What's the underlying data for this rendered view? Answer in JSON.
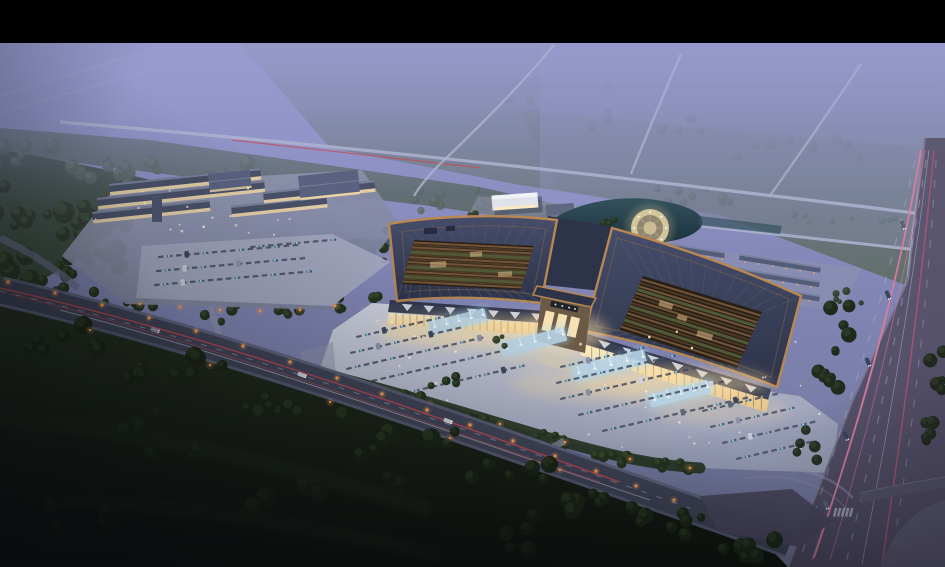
{
  "scene": {
    "type": "architectural-aerial-render",
    "time_of_day": "dusk",
    "description": "Dusk aerial rendering of a large illuminated market complex: two courtyard halls with copper-edged roofs joined by a lit central gate, a bright parking plaza with fountain strips, a secondary market complex with parking at left, a pond with a circular fountain plaza, rows of shop buildings, misty farmland with country roads behind, a tail-light streaked front road and a wide highway with pink light trails at right, dark fields and trees in the foreground, black letterbox bar at top."
  },
  "landmarks": [
    {
      "name": "main-hall-west",
      "label": "West market hall with courtyard roof"
    },
    {
      "name": "main-hall-east",
      "label": "East market hall with courtyard roof"
    },
    {
      "name": "central-gate",
      "label": "Illuminated central gate pavilion"
    },
    {
      "name": "front-plaza",
      "label": "Lit plaza with parking rows and fountain strips"
    },
    {
      "name": "secondary-complex",
      "label": "Secondary market complex with parking lot"
    },
    {
      "name": "circular-plaza",
      "label": "Circular fountain plaza beside pond"
    },
    {
      "name": "pond",
      "label": "Landscape pond and canal"
    },
    {
      "name": "shop-rows",
      "label": "Rows of single-storey shop buildings"
    },
    {
      "name": "reception-building",
      "label": "White reception building"
    },
    {
      "name": "highway-east",
      "label": "Multi-lane highway with pink light trails"
    },
    {
      "name": "front-road",
      "label": "Front access road with red tail-light trails"
    },
    {
      "name": "forest-belt",
      "label": "Misty forest belt"
    },
    {
      "name": "farmland",
      "label": "Hazy farmland crossed by country roads"
    },
    {
      "name": "foreground-fields",
      "label": "Dark foreground fields and tree clusters"
    }
  ],
  "palette": {
    "letterbox": "#000000",
    "sky_top": "#9093c6",
    "sky_mid": "#8589ba",
    "sky_low": "#6e7396",
    "mist": "#989ccf",
    "field": "#6e7a85",
    "field_green": "#5c6a60",
    "forest_far": "#4e5d50",
    "forest_near": "#344430",
    "tree_mid_dark": "#26331f",
    "tree_mid_light": "#3d4d2f",
    "tree_misty_dark": "#4b5b4d",
    "tree_misty_light": "#5e6f5e",
    "tree_fore_dark": "#1b2515",
    "tree_fore_light": "#2c3a22",
    "road_far": "#aeb3d0",
    "red_trail": "#c84b50",
    "amber": "#ffa352",
    "white_trail": "#dde1f0",
    "pink_trail": "#e57a9e",
    "pink_trail2": "#b25673",
    "lane_dash": "#a8acbf",
    "median": "#8d89a4",
    "road_front": "#3f4356",
    "road_front_edge": "#5c607a",
    "road_right_top": "#5d5973",
    "road_right_low": "#4e4a63",
    "junction": "#4b4860",
    "plot": "#8f94ae",
    "parking": "#a3a8bf",
    "bar_roof": "#4a5168",
    "bar_ridge": "#7e85a0",
    "warm_strip": "#f2d9a6",
    "plaza_hi": "#d2d5e0",
    "plaza_mid": "#b6bacc",
    "plaza_lo": "#9aa0b8",
    "glow_warm": "#ffdf9e",
    "fountain": "#b9d4e6",
    "fountain_glow": "#9fdcf4",
    "spray": "#eef6fc",
    "stall": "#454c60",
    "stall_blue": "#84d6f2",
    "roof_hi": "#454d6a",
    "roof_lo": "#2d3349",
    "copper": "#b88752",
    "copper_hi": "#d9a368",
    "rib": "#6a7390",
    "court_dark": "#281f15",
    "lattice": "#7b5a3c",
    "lattice_dark": "#513c28",
    "court_green": "#57623c",
    "facade_hi": "#fdeec4",
    "facade_lo": "#e9c489",
    "saw_light": "#d6d9e4",
    "saw_dark": "#394057",
    "mullion": "#5a4a2e",
    "pond_hi": "#33515d",
    "pond_lo": "#1c333e",
    "ring_outer": "#d3c59c",
    "ring_mid": "#8f8770",
    "ring_core": "#cabd96",
    "row_roof": "#535c78",
    "row_roof_hi": "#7d86a2",
    "white_bldg": "#dfe2ea",
    "gray_roof": "#5f6880",
    "gate_body": "#6b5b46",
    "gate_lit": "#ffe9bc",
    "gate_sign": "#1e2330",
    "steps": "#cfc9b6",
    "shadow": "#23283a",
    "speck": "#fff3d0",
    "fore_hi": "#26301f",
    "fore_lo": "#0e120c",
    "vig": "#070a0e"
  }
}
